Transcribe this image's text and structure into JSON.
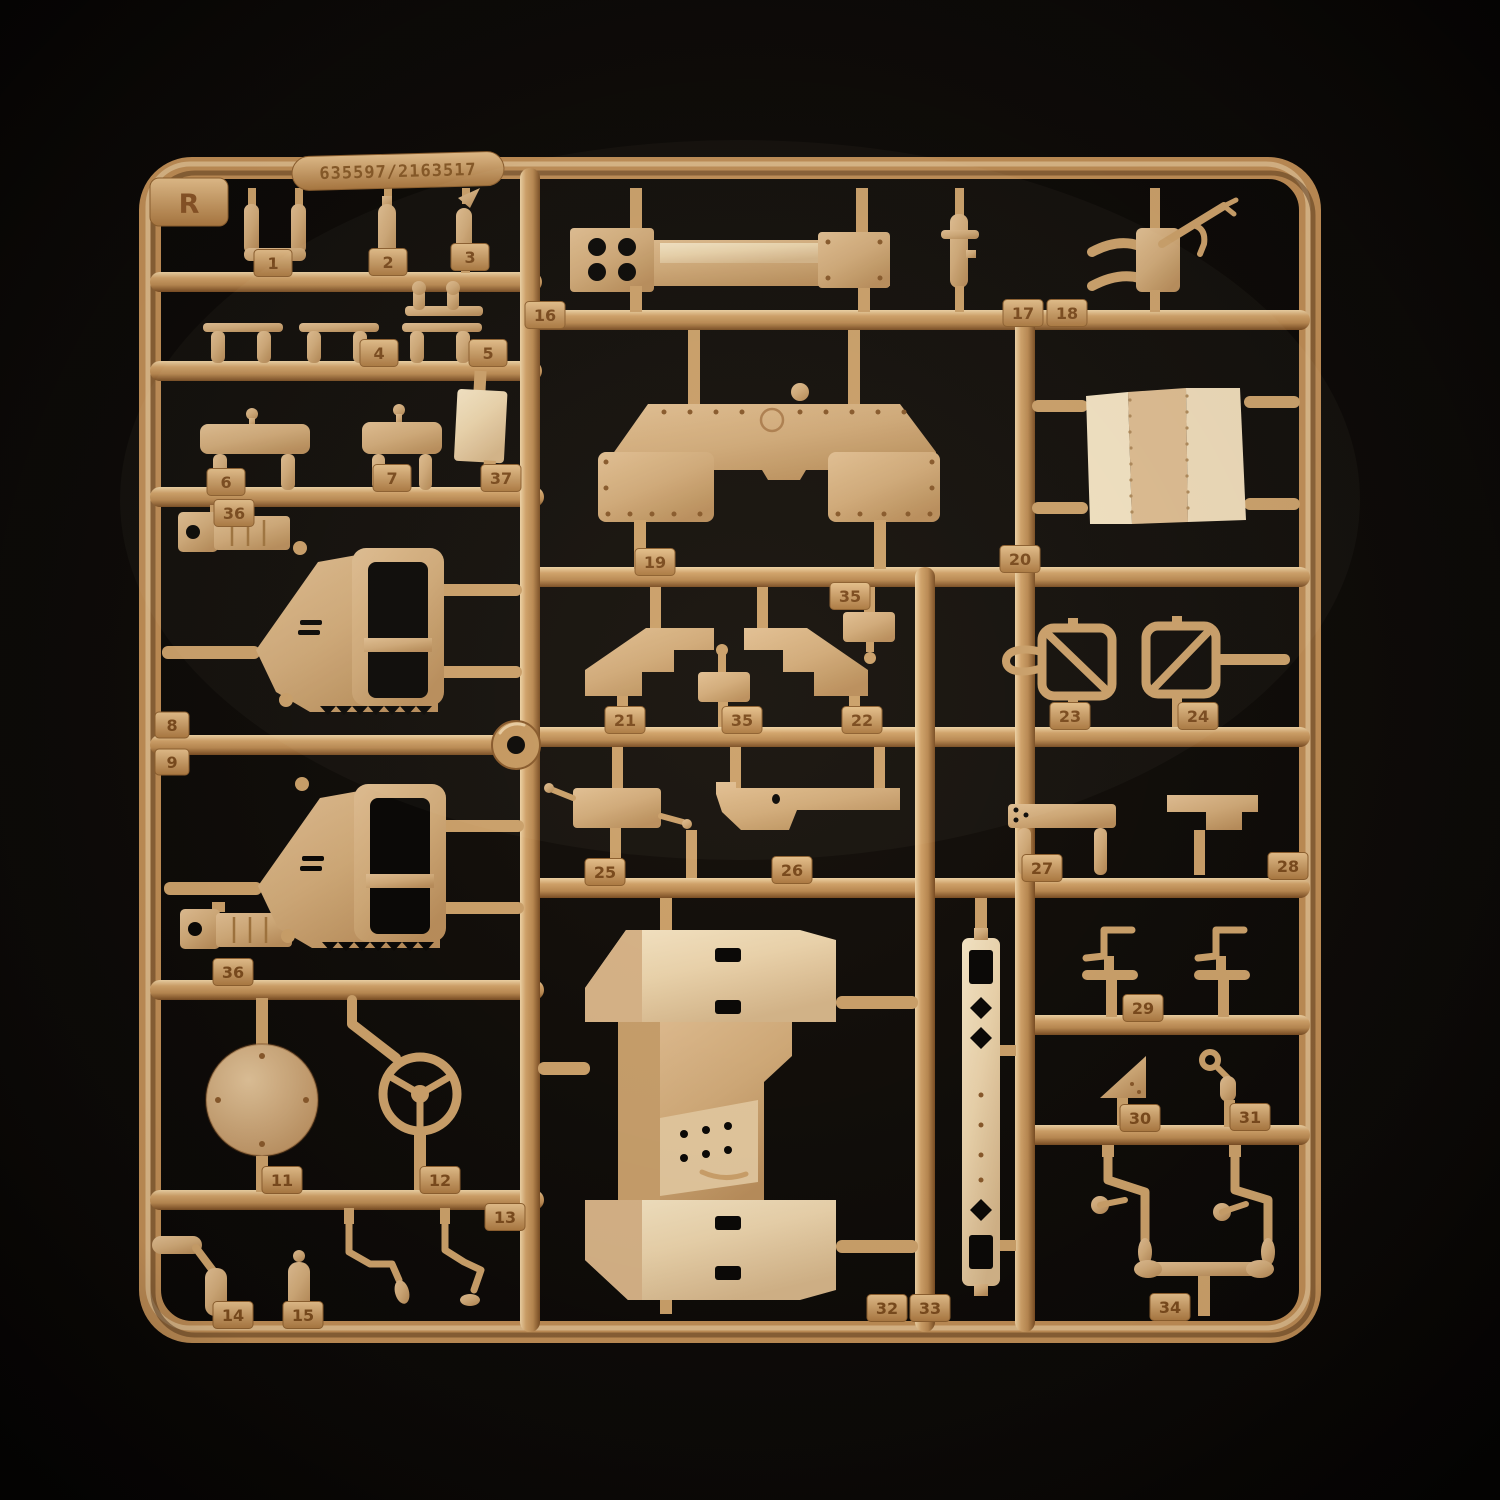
{
  "photo": {
    "subject": "model kit sprue with tan plastic parts on black background",
    "colors": {
      "background": "#0f0c09",
      "plastic_base": "#c9985f",
      "plastic_light": "#f0d4a6",
      "plastic_shadow": "#7b4e24",
      "part_face": "#d8b486",
      "part_face_light": "#ecd4ac",
      "emboss_text": "#7c4c1e"
    }
  },
  "tags": {
    "r": "R",
    "serial": "635597/2163517",
    "n1": "1",
    "n2": "2",
    "n3": "3",
    "n4": "4",
    "n5": "5",
    "n6": "6",
    "n7": "7",
    "n8": "8",
    "n9": "9",
    "n11": "11",
    "n12": "12",
    "n13": "13",
    "n14": "14",
    "n15": "15",
    "n16": "16",
    "n17": "17",
    "n18": "18",
    "n19": "19",
    "n20": "20",
    "n21": "21",
    "n22": "22",
    "n23": "23",
    "n24": "24",
    "n25": "25",
    "n26": "26",
    "n27": "27",
    "n28": "28",
    "n29": "29",
    "n30": "30",
    "n31": "31",
    "n32": "32",
    "n33": "33",
    "n34": "34",
    "n35a": "35",
    "n35b": "35",
    "n36a": "36",
    "n36b": "36",
    "n37": "37"
  },
  "parts_catalog": [
    {
      "number": "1",
      "shape": "U-bracket"
    },
    {
      "number": "2",
      "shape": "small post"
    },
    {
      "number": "3",
      "shape": "post with flag tip"
    },
    {
      "number": "4",
      "shape": "T-bar posts"
    },
    {
      "number": "5",
      "shape": "bar with knobbed posts"
    },
    {
      "number": "6",
      "shape": "rounded plate"
    },
    {
      "number": "7",
      "shape": "rounded plate"
    },
    {
      "number": "8",
      "shape": "hexagonal door with window"
    },
    {
      "number": "9",
      "shape": "hexagonal door with window"
    },
    {
      "number": "11",
      "shape": "circular disc"
    },
    {
      "number": "12",
      "shape": "steering wheel"
    },
    {
      "number": "13",
      "shape": "bent levers"
    },
    {
      "number": "14",
      "shape": "bent rod"
    },
    {
      "number": "15",
      "shape": "capsule rod"
    },
    {
      "number": "16",
      "shape": "beam with bolt holes"
    },
    {
      "number": "17",
      "shape": "small column"
    },
    {
      "number": "18",
      "shape": "gun mount"
    },
    {
      "number": "19",
      "shape": "riveted hull plate"
    },
    {
      "number": "20",
      "shape": "curved roof panel"
    },
    {
      "number": "21",
      "shape": "angled step plate"
    },
    {
      "number": "22",
      "shape": "angled step plate mirrored"
    },
    {
      "number": "23",
      "shape": "wire frame bracket"
    },
    {
      "number": "24",
      "shape": "wire frame bracket mirrored"
    },
    {
      "number": "25",
      "shape": "box mount"
    },
    {
      "number": "26",
      "shape": "stepped plate"
    },
    {
      "number": "27",
      "shape": "drilled bar"
    },
    {
      "number": "28",
      "shape": "stepped bracket"
    },
    {
      "number": "29",
      "shape": "C-clamps"
    },
    {
      "number": "30",
      "shape": "triangular gusset"
    },
    {
      "number": "31",
      "shape": "ringed pin"
    },
    {
      "number": "32",
      "shape": "fender assembly"
    },
    {
      "number": "33",
      "shape": "slotted strip"
    },
    {
      "number": "34",
      "shape": "control rods"
    },
    {
      "number": "35",
      "shape": "small plate x2"
    },
    {
      "number": "36",
      "shape": "clamp block x2"
    },
    {
      "number": "37",
      "shape": "flat panel"
    }
  ]
}
